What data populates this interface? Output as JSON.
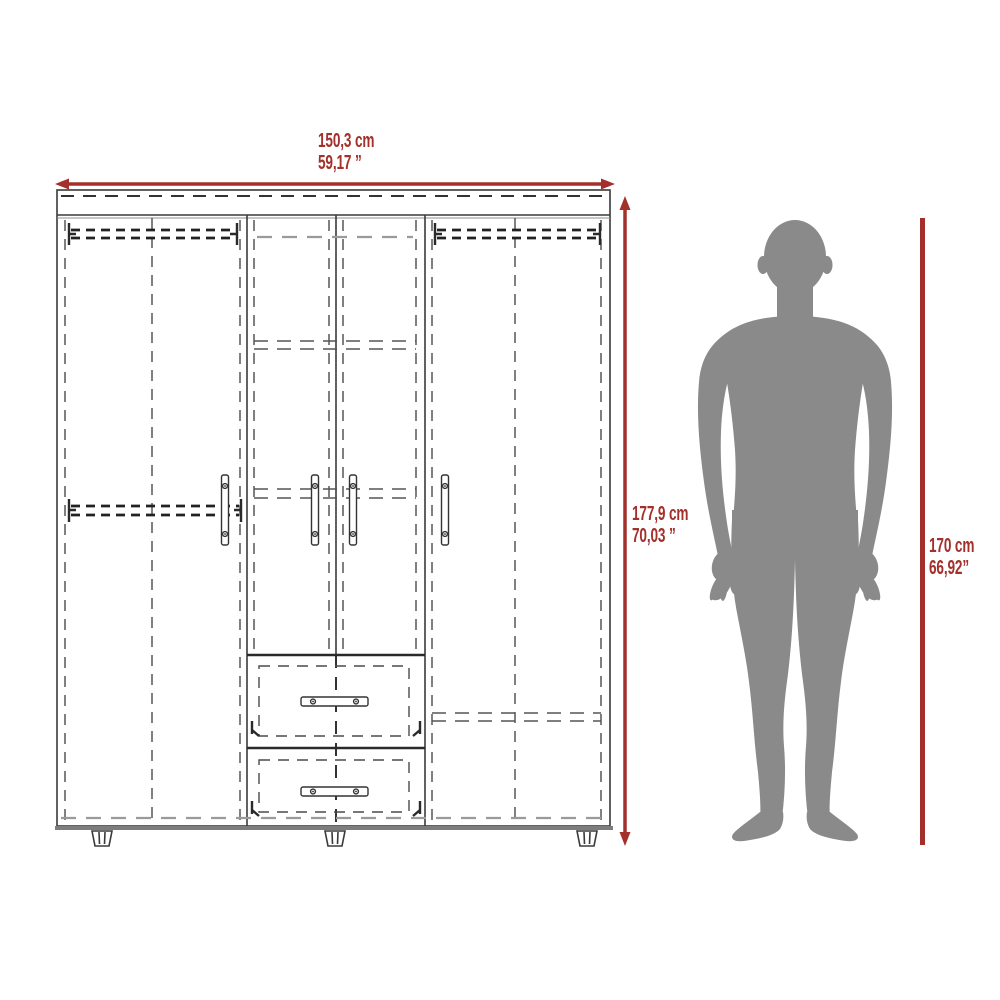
{
  "page": {
    "background": "#ffffff"
  },
  "colors": {
    "accent_red": "#a4302b",
    "line_dark": "#3a3a3a",
    "line_gray": "#9a9a9a",
    "silhouette_gray": "#8a8a8a"
  },
  "wardrobe": {
    "name": "wardrobe-technical-drawing",
    "width_label": {
      "cm": "150,3 cm",
      "inches": "59,17 ”"
    },
    "height_label": {
      "cm": "177,9 cm",
      "inches": "70,03 ”"
    }
  },
  "person": {
    "name": "human-height-reference",
    "height_label": {
      "cm": "170 cm",
      "inches": "66,92”"
    }
  }
}
